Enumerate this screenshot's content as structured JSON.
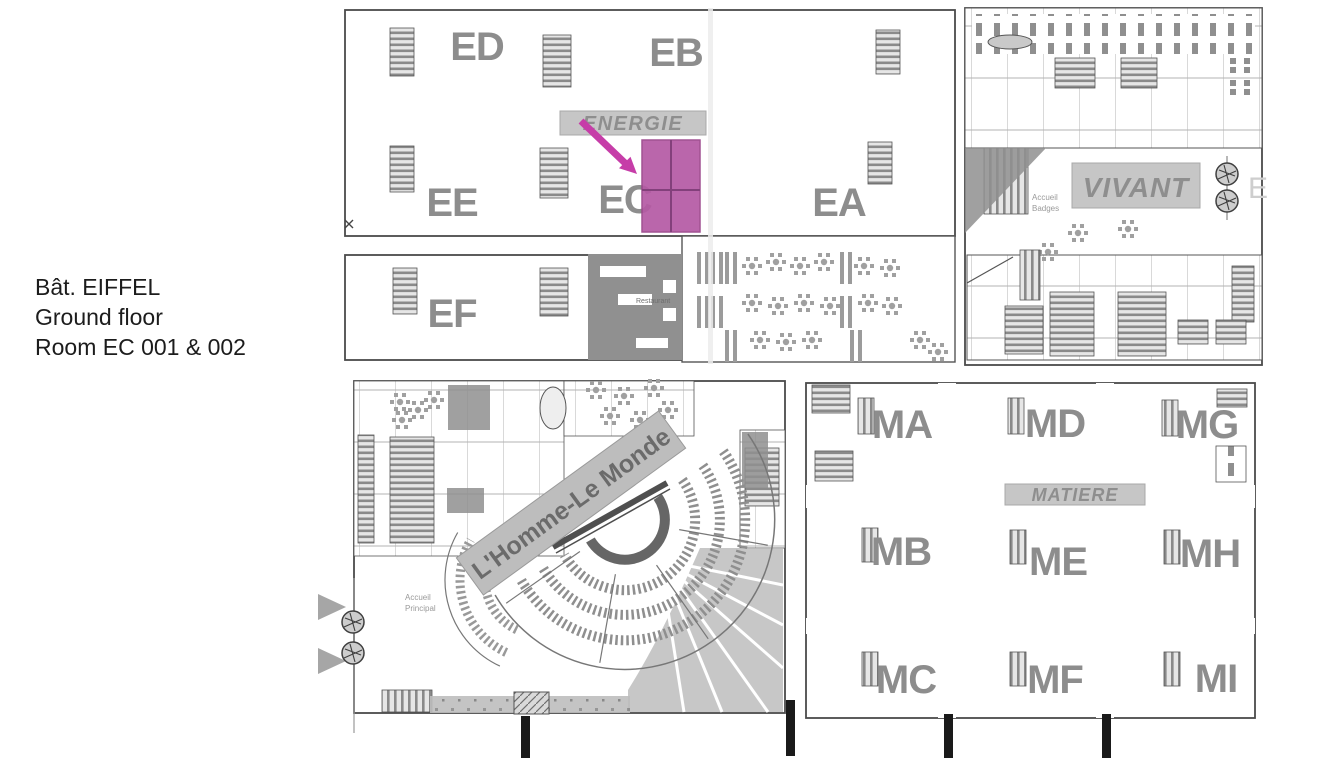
{
  "caption": {
    "building": "Bât. EIFFEL",
    "floor": "Ground floor",
    "room": "Room EC 001 & 002"
  },
  "floorplan": {
    "banners": {
      "energie": "ENERGIE",
      "vivant": "VIVANT",
      "matiere": "MATIERE",
      "homme_le_monde": "L'Homme-Le Monde"
    },
    "sections": {
      "ED": "ED",
      "EB": "EB",
      "EE": "EE",
      "EC": "EC",
      "EA": "EA",
      "EF": "EF",
      "MA": "MA",
      "MD": "MD",
      "MG": "MG",
      "MB": "MB",
      "ME": "ME",
      "MH": "MH",
      "MC": "MC",
      "MF": "MF",
      "MI": "MI"
    },
    "labels": {
      "accueil_principal_1": "Accueil",
      "accueil_principal_2": "Principal",
      "accueil_badges_1": "Accueil",
      "accueil_badges_2": "Badges",
      "restaurant": "Restaurant",
      "edge_letter": "E"
    },
    "colors": {
      "highlight_fill": "#b55aa4",
      "highlight_line": "#83407b",
      "arrow": "#c63da8",
      "section_letter": "#8d8d8d",
      "banner_bg": "#c6c6c6",
      "dark_zone": "#909090"
    }
  }
}
